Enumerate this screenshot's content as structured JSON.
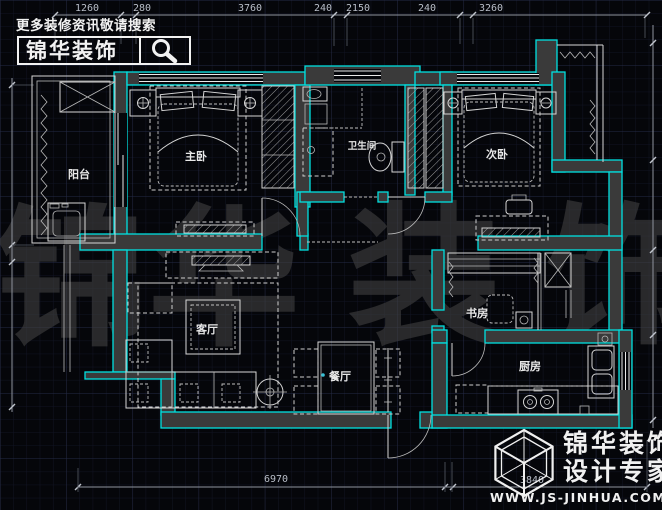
{
  "header": {
    "slogan": "更多装修资讯敬请搜索",
    "brand": "锦华装饰"
  },
  "watermark": {
    "char1": "锦",
    "char2": "华",
    "char3": "装",
    "char4": "饰"
  },
  "rooms": {
    "balcony": "阳台",
    "master": "主卧",
    "bath": "卫生间",
    "second": "次卧",
    "living": "客厅",
    "dining": "餐厅",
    "study": "书房",
    "kitchen": "厨房"
  },
  "dims": {
    "top": {
      "d1": "1260",
      "d2": "280",
      "d3": "3760",
      "d4": "240",
      "d5": "2150",
      "d6": "240",
      "d7": "3260"
    },
    "bottom": {
      "d1": "6970",
      "d2": "3840"
    }
  },
  "footer": {
    "brand_line1": "锦华装饰",
    "brand_line2": "设计专家",
    "url": "WWW.JS-JINHUA.COM"
  },
  "colors": {
    "wall_accent": "#00e0e0",
    "line": "#e8e8e8",
    "background": "#05060a"
  }
}
